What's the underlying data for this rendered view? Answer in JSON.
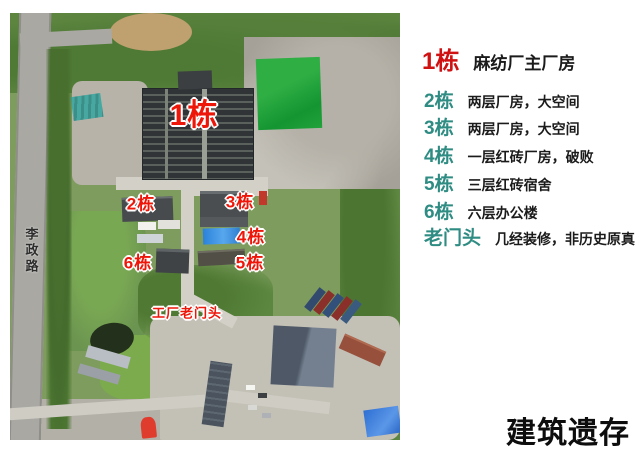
{
  "map": {
    "road_label": "李政路",
    "label_color": "#ee1609",
    "labels": [
      {
        "id": "building-1",
        "text": "1栋"
      },
      {
        "id": "building-2",
        "text": "2栋"
      },
      {
        "id": "building-3",
        "text": "3栋"
      },
      {
        "id": "building-4",
        "text": "4栋"
      },
      {
        "id": "building-5",
        "text": "5栋"
      },
      {
        "id": "building-6",
        "text": "6栋"
      },
      {
        "id": "old-gate",
        "text": "工厂老门头"
      }
    ],
    "features": {
      "green_court_color": "#23a23b",
      "blue_roof_color": "#2f82d8",
      "factory_roof_color": "#33383a"
    }
  },
  "legend": {
    "primary_color": "#cf1211",
    "secondary_color": "#2e8c83",
    "items": [
      {
        "num": "1栋",
        "desc": "麻纺厂主厂房"
      },
      {
        "num": "2栋",
        "desc": "两层厂房，大空间"
      },
      {
        "num": "3栋",
        "desc": "两层厂房，大空间"
      },
      {
        "num": "4栋",
        "desc": "一层红砖厂房，破败"
      },
      {
        "num": "5栋",
        "desc": "三层红砖宿舍"
      },
      {
        "num": "6栋",
        "desc": "六层办公楼"
      },
      {
        "num": "老门头",
        "desc": "几经装修，非历史原真"
      }
    ]
  },
  "footer": {
    "title": "建筑遗存"
  }
}
